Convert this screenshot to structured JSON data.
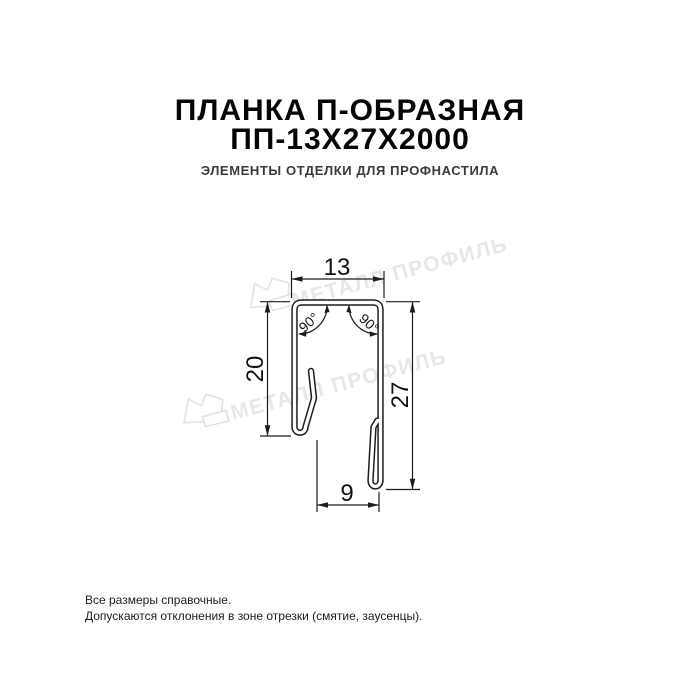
{
  "header": {
    "title_line1": "ПЛАНКА П-ОБРАЗНАЯ",
    "title_line2": "ПП-13Х27Х2000",
    "subtitle": "ЭЛЕМЕНТЫ ОТДЕЛКИ ДЛЯ ПРОФНАСТИЛА"
  },
  "drawing": {
    "type": "profile-cross-section",
    "dimensions": {
      "top_width": "13",
      "left_height": "20",
      "right_height": "27",
      "bottom_width": "9",
      "angle_left": "90°",
      "angle_right": "90°"
    },
    "line_color": "#1c1c1c"
  },
  "watermark": {
    "text": "МЕТАЛЛ ПРОФИЛЬ",
    "color": "#e7e7e7"
  },
  "footer": {
    "line1": "Все размеры справочные.",
    "line2": "Допускаются отклонения в зоне отрезки (смятие, заусенцы)."
  }
}
